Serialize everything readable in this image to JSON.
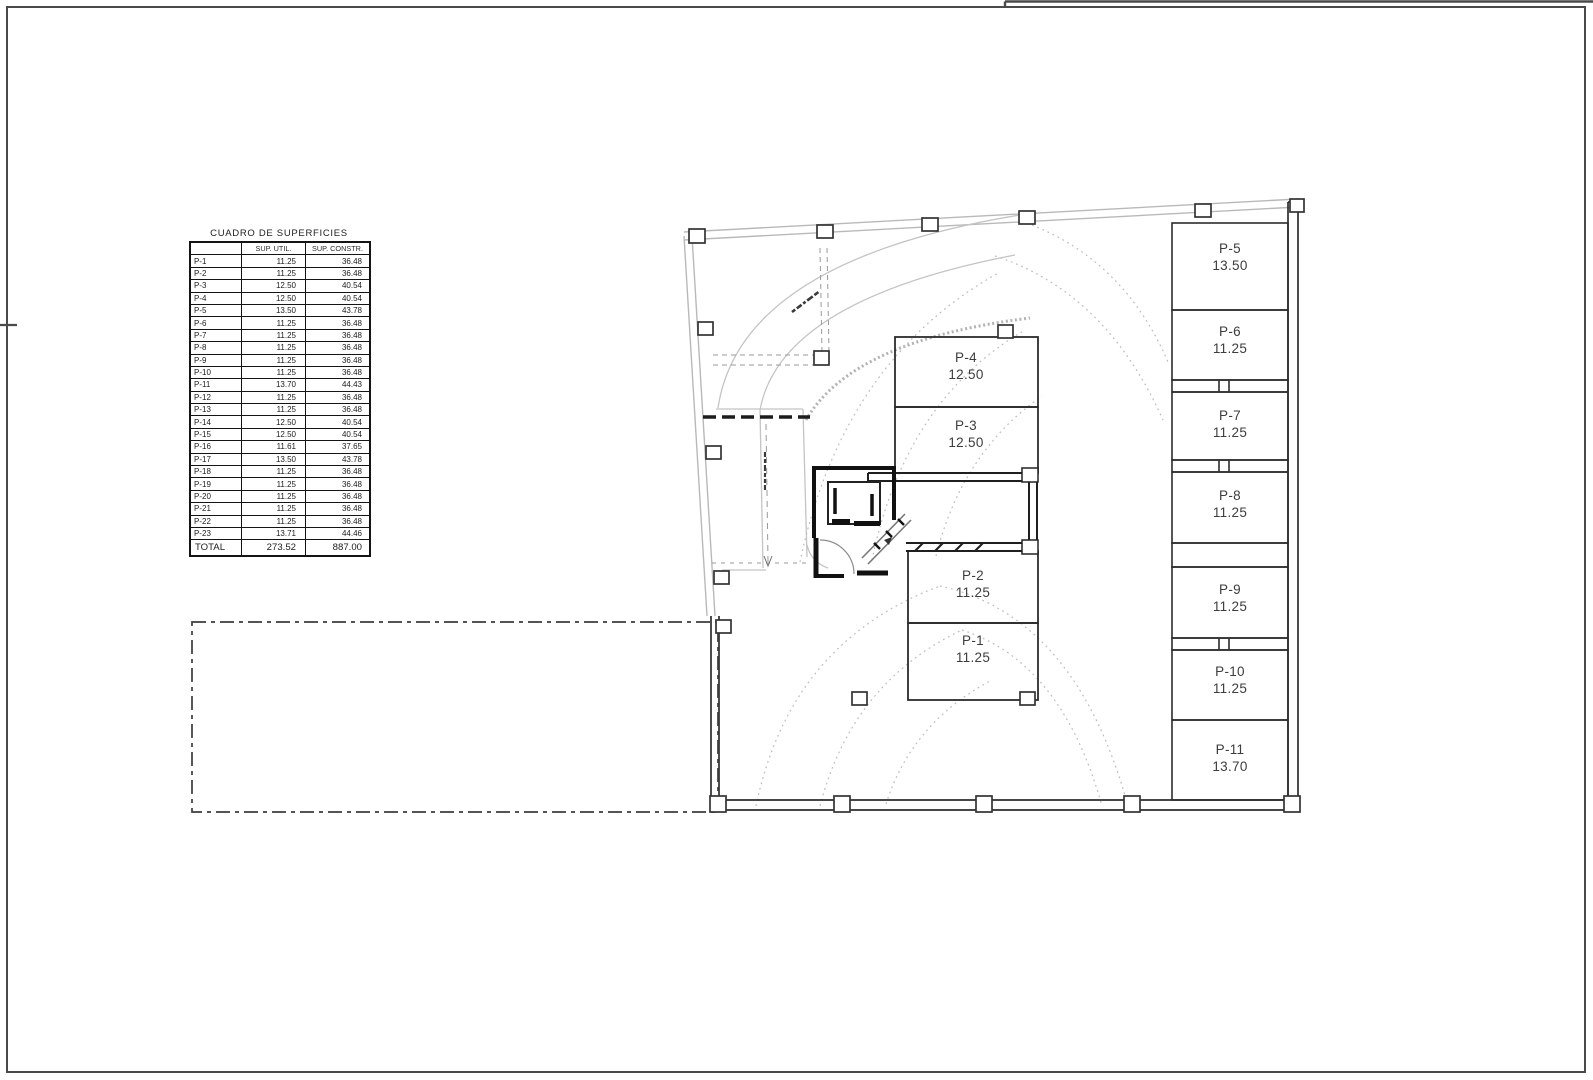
{
  "table": {
    "title": "CUADRO DE SUPERFICIES",
    "headers": {
      "col1": "",
      "col2": "SUP. UTIL.",
      "col3": "SUP. CONSTR."
    },
    "rows": [
      {
        "label": "P-1",
        "util": "11.25",
        "constr": "36.48"
      },
      {
        "label": "P-2",
        "util": "11.25",
        "constr": "36.48"
      },
      {
        "label": "P-3",
        "util": "12.50",
        "constr": "40.54"
      },
      {
        "label": "P-4",
        "util": "12.50",
        "constr": "40.54"
      },
      {
        "label": "P-5",
        "util": "13.50",
        "constr": "43.78"
      },
      {
        "label": "P-6",
        "util": "11.25",
        "constr": "36.48"
      },
      {
        "label": "P-7",
        "util": "11.25",
        "constr": "36.48"
      },
      {
        "label": "P-8",
        "util": "11.25",
        "constr": "36.48"
      },
      {
        "label": "P-9",
        "util": "11.25",
        "constr": "36.48"
      },
      {
        "label": "P-10",
        "util": "11.25",
        "constr": "36.48"
      },
      {
        "label": "P-11",
        "util": "13.70",
        "constr": "44.43"
      },
      {
        "label": "P-12",
        "util": "11.25",
        "constr": "36.48"
      },
      {
        "label": "P-13",
        "util": "11.25",
        "constr": "36.48"
      },
      {
        "label": "P-14",
        "util": "12.50",
        "constr": "40.54"
      },
      {
        "label": "P-15",
        "util": "12.50",
        "constr": "40.54"
      },
      {
        "label": "P-16",
        "util": "11.61",
        "constr": "37.65"
      },
      {
        "label": "P-17",
        "util": "13.50",
        "constr": "43.78"
      },
      {
        "label": "P-18",
        "util": "11.25",
        "constr": "36.48"
      },
      {
        "label": "P-19",
        "util": "11.25",
        "constr": "36.48"
      },
      {
        "label": "P-20",
        "util": "11.25",
        "constr": "36.48"
      },
      {
        "label": "P-21",
        "util": "11.25",
        "constr": "36.48"
      },
      {
        "label": "P-22",
        "util": "11.25",
        "constr": "36.48"
      },
      {
        "label": "P-23",
        "util": "13.71",
        "constr": "44.46"
      }
    ],
    "total": {
      "label": "TOTAL",
      "util": "273.52",
      "constr": "887.00"
    }
  },
  "plan": {
    "stalls": [
      {
        "name": "P-1",
        "area": "11.25"
      },
      {
        "name": "P-2",
        "area": "11.25"
      },
      {
        "name": "P-3",
        "area": "12.50"
      },
      {
        "name": "P-4",
        "area": "12.50"
      },
      {
        "name": "P-5",
        "area": "13.50"
      },
      {
        "name": "P-6",
        "area": "11.25"
      },
      {
        "name": "P-7",
        "area": "11.25"
      },
      {
        "name": "P-8",
        "area": "11.25"
      },
      {
        "name": "P-9",
        "area": "11.25"
      },
      {
        "name": "P-10",
        "area": "11.25"
      },
      {
        "name": "P-11",
        "area": "13.70"
      }
    ],
    "colors": {
      "wall": "#2d2d2d",
      "core": "#111111",
      "boundary": "#b9b9b9",
      "arc_dotted": "#bdbdbd",
      "label_text": "#3d3d3d",
      "page_border": "#4a4a4a"
    }
  }
}
